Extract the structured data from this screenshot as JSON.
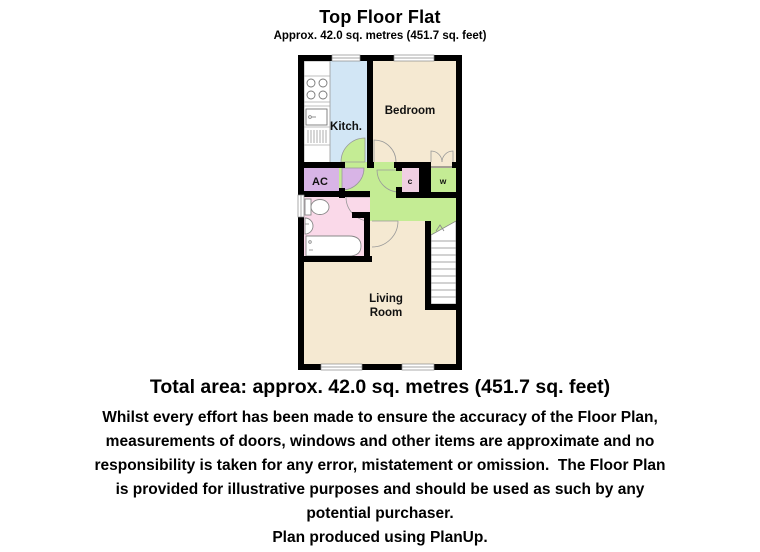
{
  "header": {
    "title": "Top Floor Flat",
    "subtitle": "Approx. 42.0 sq. metres (451.7 sq. feet)"
  },
  "plan": {
    "rooms": {
      "kitchen": "Kitch.",
      "bedroom": "Bedroom",
      "airing_cupboard": "AC",
      "cupboard": "c",
      "wardrobe": "w",
      "living_room_line1": "Living",
      "living_room_line2": "Room"
    }
  },
  "colors": {
    "wall": "#000000",
    "kitchen": "#d2e6f5",
    "bedroom": "#f5e9d2",
    "living_room": "#f5e9d2",
    "hallway": "#c4ec94",
    "wardrobe": "#c4ec94",
    "airing_cupboard": "#d8b4e6",
    "bathroom": "#fad9e9",
    "cupboard": "#f0cfe2"
  },
  "footer": {
    "total_area": "Total area: approx. 42.0 sq. metres (451.7 sq. feet)",
    "disclaimer_lines": [
      "Whilst every effort has been made to ensure the accuracy of the Floor Plan,",
      "measurements of doors, windows and other items are approximate and no",
      "responsibility is taken for any error, mistatement or omission.  The Floor Plan",
      "is provided for illustrative purposes and should be used as such by any",
      "potential purchaser."
    ],
    "credit": "Plan produced using PlanUp."
  }
}
